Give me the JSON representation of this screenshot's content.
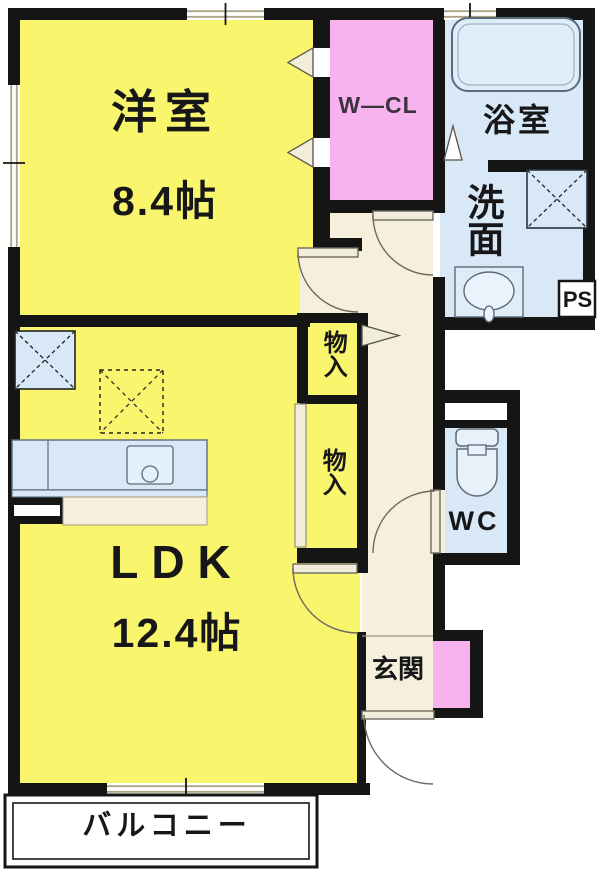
{
  "plan": {
    "rooms": {
      "western_room": {
        "label": "洋室",
        "size": "8.4帖"
      },
      "walk_in_closet": {
        "label": "W—CL"
      },
      "bathroom": {
        "label": "浴室"
      },
      "washroom": {
        "label": "洗面"
      },
      "pipe_space": {
        "label": "PS"
      },
      "storage_upper": {
        "label": "物入"
      },
      "storage_lower": {
        "label": "物入"
      },
      "toilet": {
        "label": "WC"
      },
      "ldk": {
        "label": "LDK",
        "size": "12.4帖"
      },
      "entrance": {
        "label": "玄関"
      },
      "balcony": {
        "label": "バルコニー"
      }
    },
    "colors": {
      "wall": "#151515",
      "room_yellow": "#F9F56C",
      "closet_pink": "#F8B3EE",
      "water_blue": "#D8E8F6",
      "floor_cream": "#F6EFDC",
      "fixture_outline": "#5A6B7A",
      "balcony_white": "#FFFFFF"
    }
  }
}
